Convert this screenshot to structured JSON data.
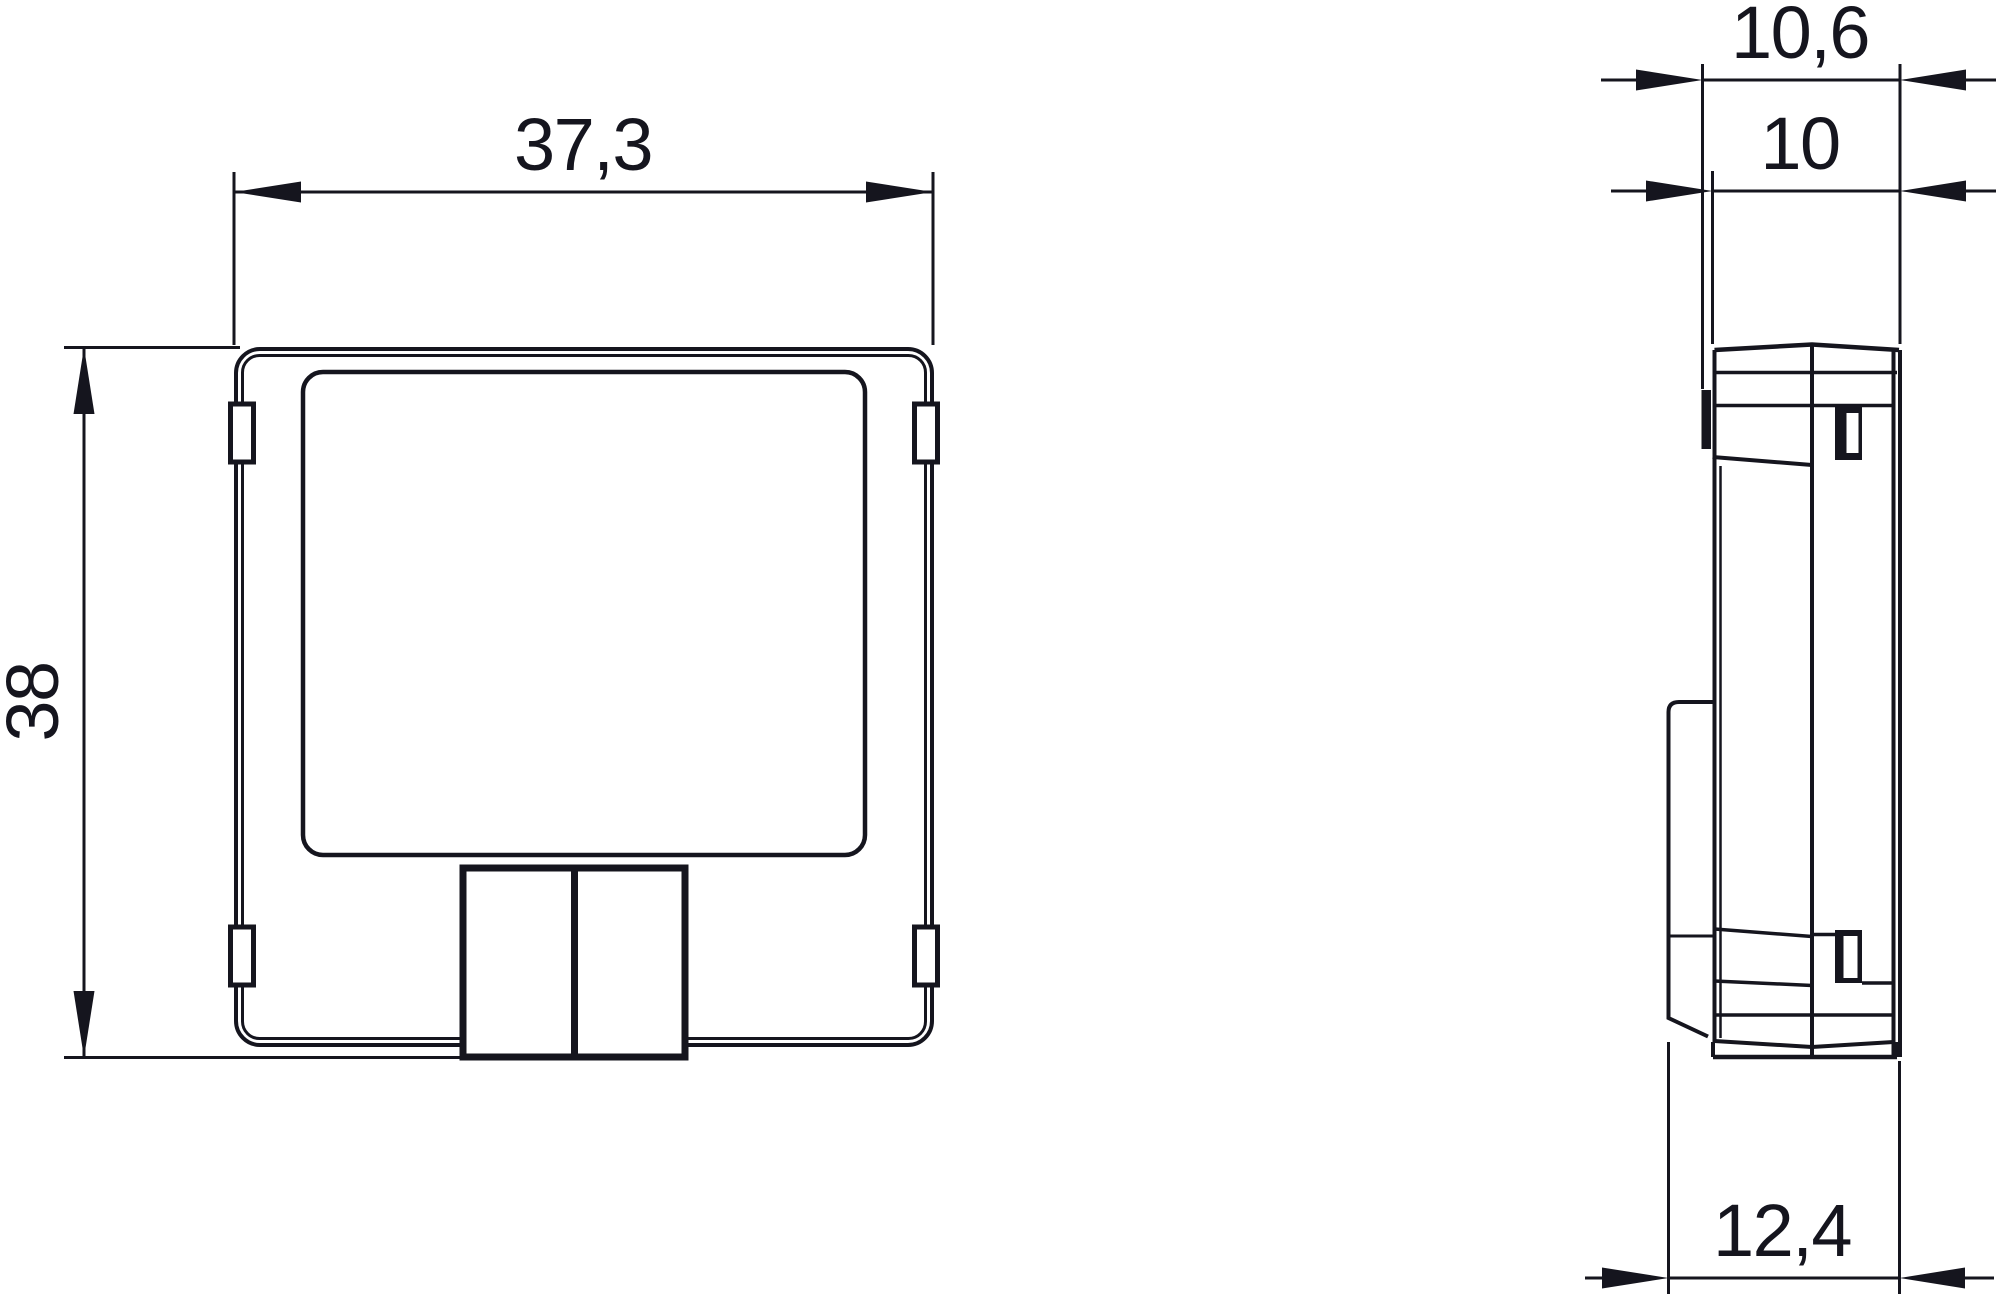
{
  "drawing": {
    "background": "#ffffff",
    "line_color": "#15151e",
    "type": "technical-dimension-drawing",
    "views": [
      {
        "id": "front-view",
        "description": "front view of module with label area and bottom connector"
      },
      {
        "id": "side-view",
        "description": "side profile view with DIN clip and terminal cover"
      }
    ],
    "dimensions": {
      "front_width": {
        "label": "37,3",
        "value": 37.3
      },
      "front_height": {
        "label": "38",
        "value": 38
      },
      "depth_overall": {
        "label": "10,6",
        "value": 10.6
      },
      "depth_body": {
        "label": "10",
        "value": 10
      },
      "depth_total": {
        "label": "12,4",
        "value": 12.4
      }
    }
  }
}
